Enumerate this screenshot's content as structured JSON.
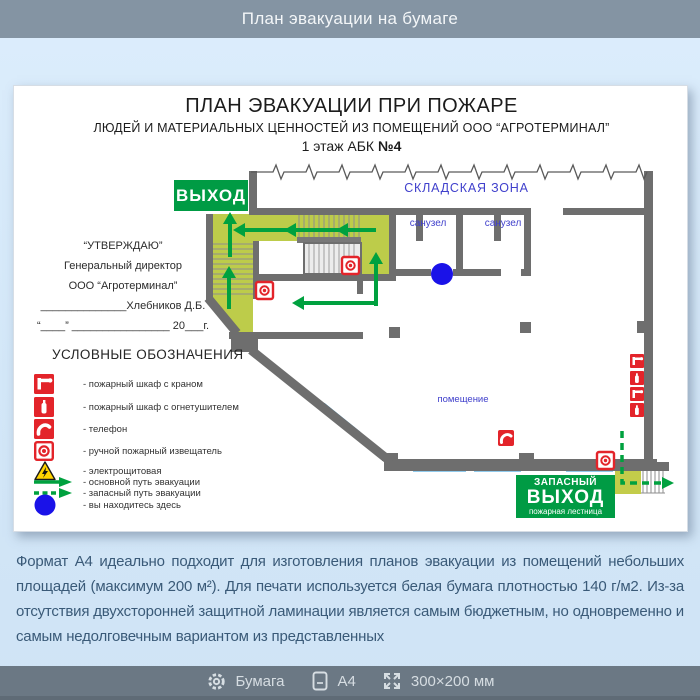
{
  "header": {
    "title": "План эвакуации на бумаге"
  },
  "document": {
    "title1": "ПЛАН ЭВАКУАЦИИ ПРИ ПОЖАРЕ",
    "title2": "ЛЮДЕЙ И МАТЕРИАЛЬНЫХ ЦЕННОСТЕЙ ИЗ ПОМЕЩЕНИЙ ООО “АГРОТЕРМИНАЛ”",
    "title3a": "1 этаж АБК ",
    "title3b": "№4",
    "approval": {
      "line1": "“УТВЕРЖДАЮ”",
      "line2": "Генеральный директор",
      "line3": "ООО “Агротерминал”",
      "line4": "______________Хлебников Д.Б.",
      "line5": "“____” ________________ 20___г."
    },
    "plan": {
      "exit_sign": "ВЫХОД",
      "warehouse_label": "СКЛАДСКАЯ ЗОНА",
      "bathroom1": "санузел",
      "bathroom2": "санузел",
      "room_label": "помещение",
      "emergency_exit_line1": "ЗАПАСНЫЙ",
      "emergency_exit_line2": "ВЫХОД",
      "emergency_exit_line3": "пожарная лестница"
    },
    "legend": {
      "title": "УСЛОВНЫЕ ОБОЗНАЧЕНИЯ",
      "items": [
        {
          "icon": "fire-cabinet-hose-icon",
          "label": "- пожарный шкаф с краном"
        },
        {
          "icon": "fire-cabinet-extinguisher-icon",
          "label": "- пожарный шкаф с огнетушителем"
        },
        {
          "icon": "telephone-icon",
          "label": "- телефон"
        },
        {
          "icon": "manual-call-point-icon",
          "label": "- ручной пожарный извещатель"
        },
        {
          "icon": "electrical-room-icon",
          "label": "- электрощитовая"
        },
        {
          "icon": "main-route-arrow-icon",
          "label": "- основной путь эвакуации"
        },
        {
          "icon": "reserve-route-arrow-icon",
          "label": "- запасный путь эвакуации"
        },
        {
          "icon": "you-are-here-icon",
          "label": "- вы находитесь здесь"
        }
      ]
    }
  },
  "description": "Формат А4 идеально подходит для изготовления планов эвакуации из помещений небольших площадей (максимум 200 м²). Для печати используется белая бумага плотностью 140 г/м2. Из-за отсутствия двухсторонней защитной ламинации является самым бюджетным, но одновременно и самым недолговечным вариантом из представленных",
  "footer": {
    "items": [
      {
        "icon": "gear-icon",
        "label": "Бумага"
      },
      {
        "icon": "page-icon",
        "label": "A4"
      },
      {
        "icon": "dimensions-icon",
        "label": "300×200 мм"
      }
    ]
  },
  "colors": {
    "header_bg": "#8494a3",
    "footer_bg": "#6b7884",
    "accent_green": "#009b44",
    "route_green": "#00a13f",
    "fire_red": "#e3242a",
    "corridor_olive": "#bdcc4a",
    "window_blue": "#2296d8",
    "you_are_here_blue": "#1a12e8",
    "plan_label_blue": "#4040cc",
    "wall_gray": "#6e6e6e",
    "description_text": "#3a5a78"
  }
}
